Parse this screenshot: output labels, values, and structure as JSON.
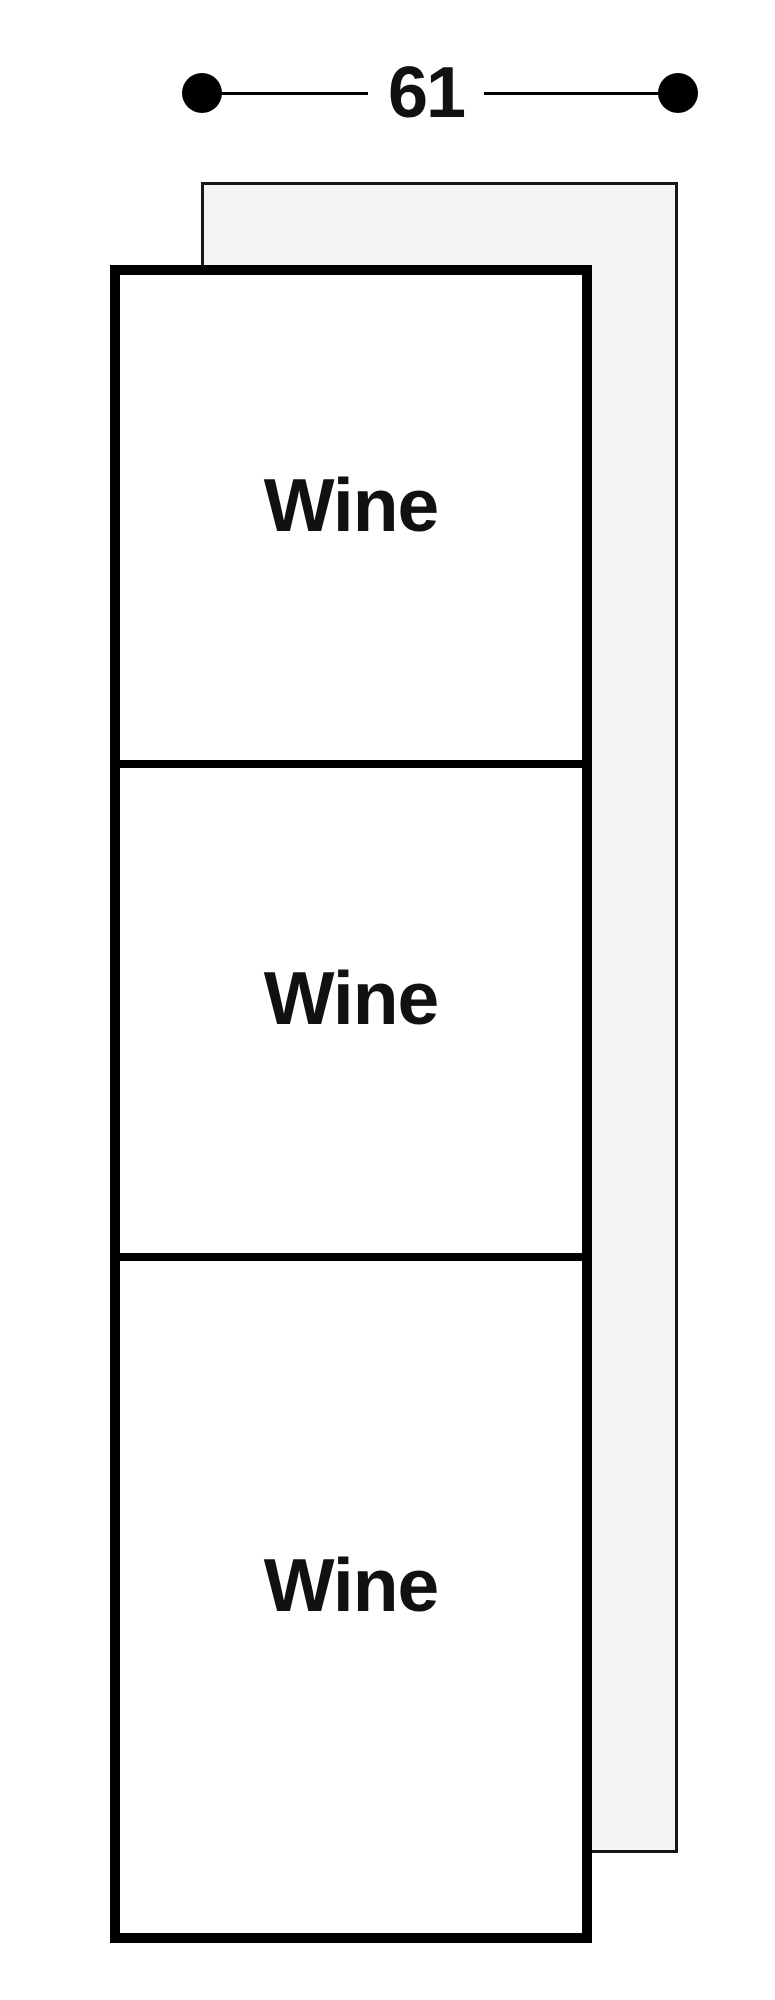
{
  "diagram": {
    "type": "appliance-dimension-drawing",
    "dimension": {
      "value": "61"
    },
    "compartments": [
      {
        "label": "Wine"
      },
      {
        "label": "Wine"
      },
      {
        "label": "Wine"
      }
    ],
    "colors": {
      "outline": "#000000",
      "back_panel_fill": "#f4f4f4",
      "back_panel_border": "#161616",
      "text": "#111111",
      "background": "#ffffff"
    }
  }
}
